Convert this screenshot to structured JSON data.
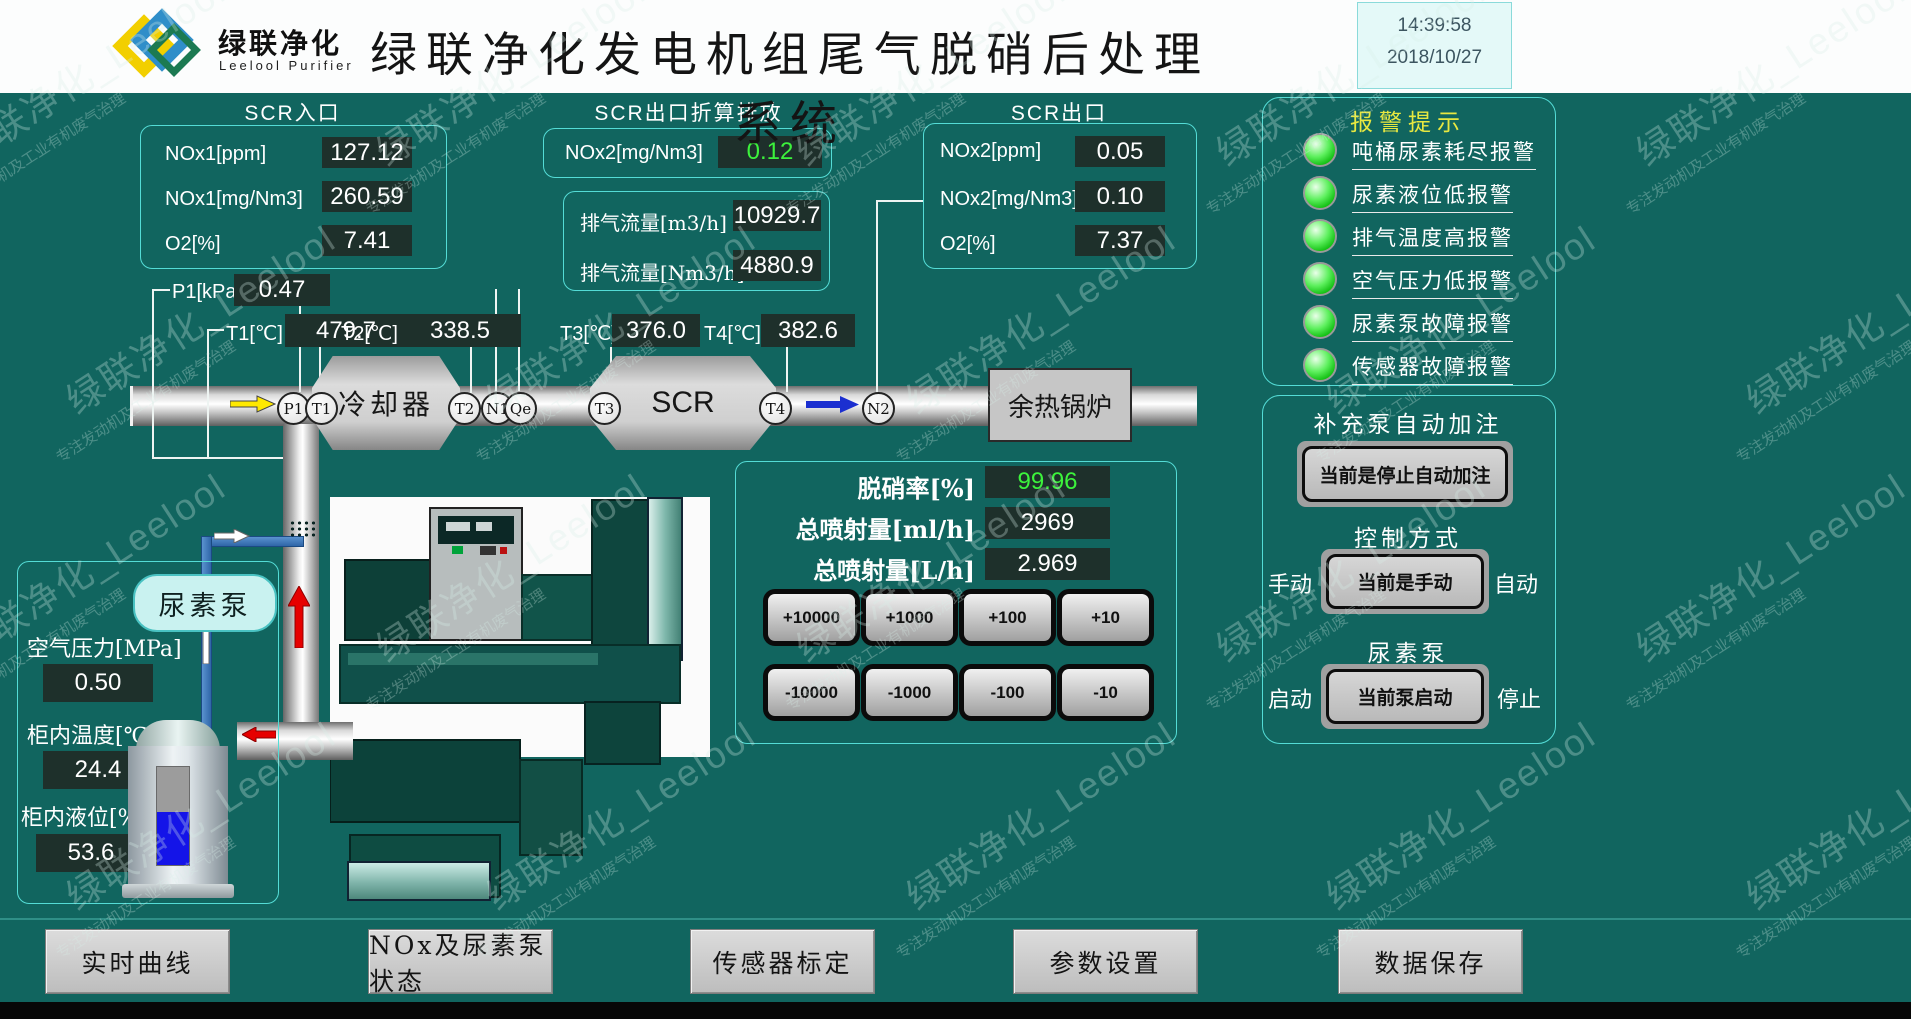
{
  "header": {
    "logo_cn": "绿联净化",
    "logo_en": "Leelool Purifier",
    "title": "绿联净化发电机组尾气脱硝后处理系统",
    "time": "14:39:58",
    "date": "2018/10/27"
  },
  "scr_inlet": {
    "title": "SCR入口",
    "rows": [
      {
        "label": "NOx1[ppm]",
        "value": "127.12"
      },
      {
        "label": "NOx1[mg/Nm3]",
        "value": "260.59"
      },
      {
        "label": "O2[%]",
        "value": "7.41"
      }
    ]
  },
  "scr_outlet_conv": {
    "title": "SCR出口折算排放",
    "label": "NOx2[mg/Nm3]",
    "value": "0.12"
  },
  "exhaust_flow": {
    "rows": [
      {
        "label": "排气流量[m3/h]",
        "value": "10929.7"
      },
      {
        "label": "排气流量[Nm3/h]",
        "value": "4880.9"
      }
    ]
  },
  "scr_outlet": {
    "title": "SCR出口",
    "rows": [
      {
        "label": "NOx2[ppm]",
        "value": "0.05"
      },
      {
        "label": "NOx2[mg/Nm3]",
        "value": "0.10"
      },
      {
        "label": "O2[%]",
        "value": "7.37"
      }
    ]
  },
  "point_sensors": {
    "p1": {
      "label": "P1[kPa]",
      "value": "0.47"
    },
    "t1": {
      "label": "T1[℃]",
      "value": "479.7"
    },
    "t2": {
      "label": "T2[℃]",
      "value": "338.5"
    },
    "t3": {
      "label": "T3[℃]",
      "value": "376.0"
    },
    "t4": {
      "label": "T4[℃]",
      "value": "382.6"
    }
  },
  "pipeline": {
    "cooler": "冷却器",
    "scr": "SCR",
    "boiler": "余热锅炉",
    "urea_pump": "尿素泵",
    "tags": [
      "P1",
      "T1",
      "T2",
      "N1",
      "Qe",
      "T3",
      "T4",
      "N2"
    ]
  },
  "cabinet": {
    "rows": [
      {
        "label": "空气压力[MPa]",
        "value": "0.50"
      },
      {
        "label": "柜内温度[℃]",
        "value": "24.4"
      },
      {
        "label": "柜内液位[%]",
        "value": "53.6"
      }
    ],
    "level_percent": 53.6
  },
  "injection": {
    "rows": [
      {
        "label": "脱硝率[%]",
        "value": "99.96"
      },
      {
        "label": "总喷射量[ml/h]",
        "value": "2969"
      },
      {
        "label": "总喷射量[L/h]",
        "value": "2.969"
      }
    ],
    "adjust": [
      "+10000",
      "+1000",
      "+100",
      "+10",
      "-10000",
      "-1000",
      "-100",
      "-10"
    ]
  },
  "alarms": {
    "title": "报警提示",
    "items": [
      "吨桶尿素耗尽报警",
      "尿素液位低报警",
      "排气温度高报警",
      "空气压力低报警",
      "尿素泵故障报警",
      "传感器故障报警"
    ]
  },
  "controls": {
    "refill_title": "补充泵自动加注",
    "refill_button": "当前是停止自动加注",
    "mode_title": "控制方式",
    "mode_left": "手动",
    "mode_button": "当前是手动",
    "mode_right": "自动",
    "pump_title": "尿素泵",
    "pump_left": "启动",
    "pump_button": "当前泵启动",
    "pump_right": "停止"
  },
  "nav": [
    "实时曲线",
    "NOx及尿素泵状态",
    "传感器标定",
    "参数设置",
    "数据保存"
  ],
  "watermark": {
    "line1": "绿联净化_Leelool",
    "line2": "专注发动机及工业有机废气治理"
  },
  "colors": {
    "background": "#11655f",
    "panel_border": "#54dcd6",
    "value_box": "#1e302b",
    "value_text": "#ffffff",
    "good_value": "#3cf23c",
    "alarm_lamp": "#22dd22",
    "alarm_title": "#e8e840"
  }
}
